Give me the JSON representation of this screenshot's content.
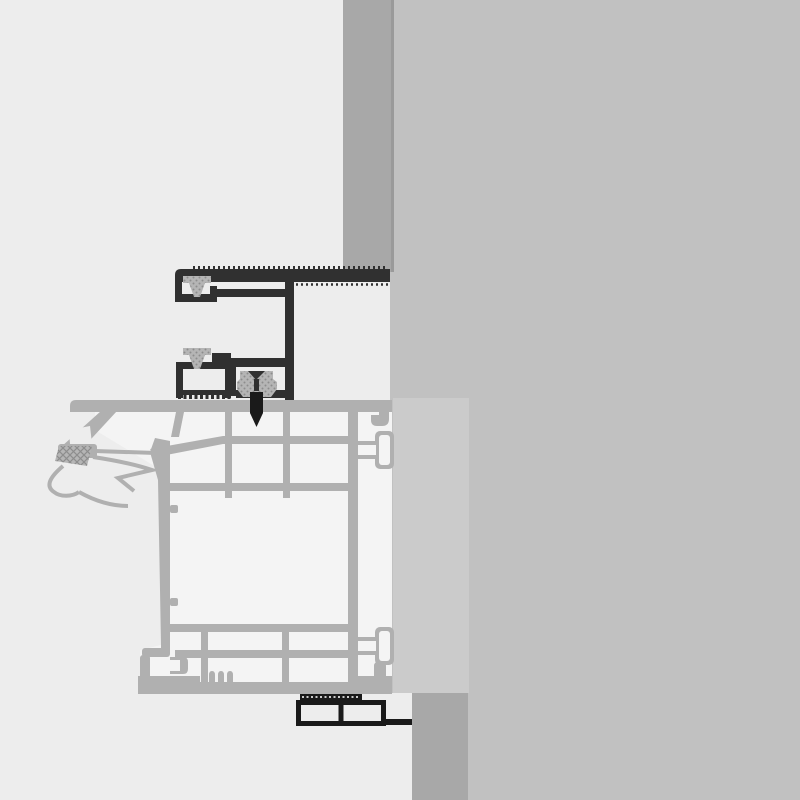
{
  "diagram": {
    "type": "technical-cross-section",
    "description": "Cross-section installation detail drawing: dark aluminium cover profile with brush seals and fixing screw mounted on a light grey PVC window frame profile, set against a wall reveal",
    "text_labels": [],
    "components": [
      "wall-slab",
      "wall-reveal-strip-top",
      "wall-reveal-strip-bottom",
      "mounting-panel",
      "aluminium-cover-profile",
      "brush-seal-upper",
      "brush-seal-lower",
      "roller-gasket",
      "fixing-screw",
      "pvc-frame-profile",
      "frame-chambers",
      "coextruded-gasket",
      "drip-fins",
      "screw-boss-connectors",
      "bottom-track-profile"
    ]
  },
  "colors": {
    "bg": "#ededed",
    "wall": "#c1c1c1",
    "reveal": "#a8a8a8",
    "revealEdge": "#9a9a9a",
    "panel": "#cbcbcb",
    "frame": "#b0b0b0",
    "cell": "#f4f4f4",
    "dark": "#303030",
    "track": "#1a1a1a",
    "seal": "#b5b5b5",
    "sealDot": "#8d8d8d"
  }
}
